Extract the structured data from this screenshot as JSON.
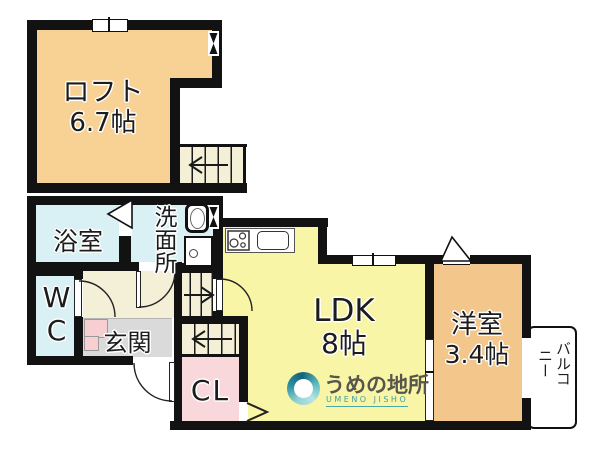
{
  "rooms": {
    "loft": {
      "name": "ロフト",
      "size": "6.7帖"
    },
    "bathroom": {
      "name": "浴室"
    },
    "washroom": {
      "name": "洗面所"
    },
    "wc": {
      "name": "WC"
    },
    "entrance": {
      "name": "玄関"
    },
    "ldk": {
      "name": "LDK",
      "size": "8帖"
    },
    "western_room": {
      "name": "洋室",
      "size": "3.4帖"
    },
    "closet": {
      "name": "CL"
    },
    "balcony": {
      "name": "バルコニー"
    }
  },
  "branding": {
    "company_name": "うめの地所",
    "company_name_en": "UMENO JISHO"
  },
  "colors": {
    "wall": "#121212",
    "ldk_fill": "#f8f6a6",
    "loft_fill": "#f8d294",
    "western_room_fill": "#f3c78b",
    "wet_area_fill": "#d9f0f4",
    "closet_fill": "#f9d8db",
    "entrance_floor": "#dadada",
    "hall_fill": "#f4f0d8",
    "logo_teal": "#3d9fa3"
  }
}
